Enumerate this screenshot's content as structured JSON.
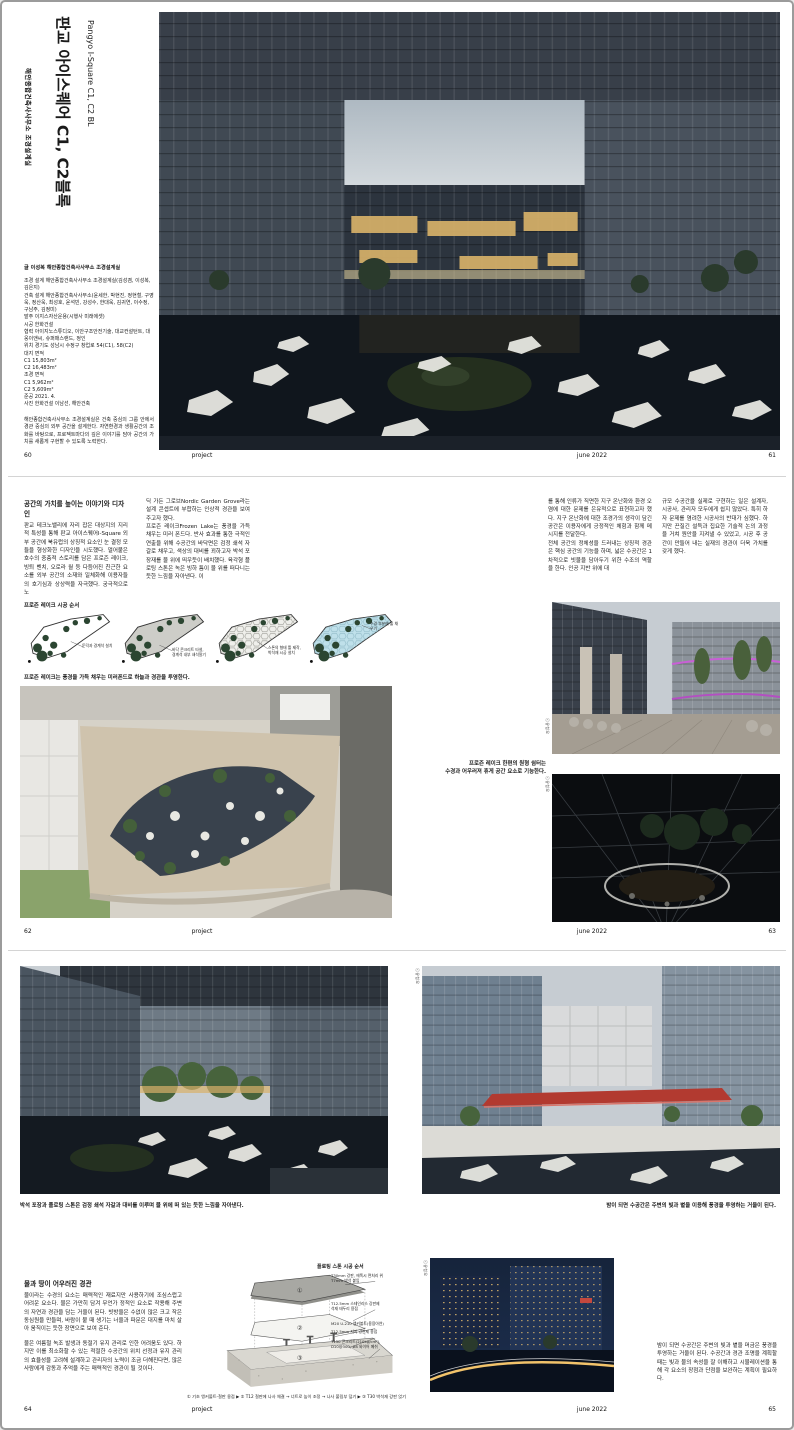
{
  "footer": {
    "section_label": "project",
    "issue_label": "june 2022"
  },
  "spread1": {
    "page_left": "60",
    "page_right": "61",
    "title_kr": "판교 아이스퀘어 C1, C2블록",
    "title_en": "Pangyo I-Square C1, C2 BL",
    "title_byline": "해안종합건축사사무소 조경설계실",
    "lead": "글 이성복  해안종합건축사사무소 조경설계실",
    "credits": [
      "조경 설계 해안종합건축사사무소 조경설계실(김성겸, 이성복, 김은지)",
      "건축 설계 해안종합건축사사무소(윤세한, 박현진, 정현철, 구영욱, 정산욱, 최성호, 윤석빈, 강성수, 한대욱, 김귀연, 이수정, 구남주, 김정미)",
      "발주 이지스자산운용(시행사 미래에셋)",
      "시공 한화건설",
      "협력 아이지노스튜디오, 이안구조안전기술, 대교컨설턴트, 대웅이앤씨, 슈퍼매스랜드, 정인",
      "위치 경기도 성남시 수정구 창업로 54(C1), 58(C2)",
      "대지 면적",
      "C1 15,803m²",
      "C2 16,483m²",
      "조경 면적",
      "C1 5,962m²",
      "C2 5,609m²",
      "준공 2021. 4.",
      "사진 한화건설 이남선, 해안건축"
    ],
    "firm_note": "해안종합건축사사무소 조경설계실은 건축 중심의 그룹 안에서 경관 중심의 외부 공간을 설계한다. 자연환경과 생활공간의 조화를 바탕으로, 프로젝트마다의 깊은 이야기를 담아 공간의 가치를 새롭게 구현할 수 있도록 노력한다."
  },
  "spread2": {
    "page_left": "62",
    "page_right": "63",
    "heading": "공간의 가치를 높이는 이야기와 디자인",
    "col1": "판교 테크노밸리에 자리 잡은 대상지의 지리적 특성을 통해 판교 아이스퀘어I-Square 외부 공간에 북유럽의 상징적 요소인 눈 결정 모듈을 형상화한 디자인을 시도했다. 얼어붙은 호수의 중층적 스토리를 담은 프로즌 레이크, 빙퇴 벤치, 오로라 월 등 다듬어진 친근한 요소를 외부 공간의 소재와 일체화해 이용자들의 호기심과 상상력을 자극했다. 궁극적으로 노",
    "col2": "딕 가든 그로브Nordic Garden Grove라는 설계 콘셉트에 부합하는 인상적 경관을 보여주고자 했다.\n프로즌 레이크Frozen Lake는 풍경을 가득 채우는 미러 폰드다. 반사 효과를 통한 극적인 연출을 위해 수공간의 바닥면은 검정 쇄석 자갈로 채우고, 색상의 대비를 꾀하고자 박석 포장재를 물 위에 띄우듯이 배치했다. 육각형 플로팅 스톤은 녹은 빙하 틈이 물 위를 떠다니는 듯한 느낌을 자아낸다. 이",
    "col3": "를 통해 인류가 직면한 지구 온난화와 환경 오염에 대한 문제를 은유적으로 표현하고자 했다. 지구 온난화에 대한 조경가의 생각이 담긴 공간은 이용자에게 긍정적인 체험과 함께 메시지를 전달한다.\n전체 공간의 정체성을 드러내는 상징적 경관은 핵심 공간의 기능을 하며, 넓은 수공간은 1차적으로 빗물을 담아두기 위한 수조의 역할을 한다. 인공 지반 위에 대",
    "col4": "규모 수공간을 실제로 구현하는 일은 설계자, 시공사, 관리자 모두에게 쉽지 않았다. 특히 하자 문제를 염려한 시공사의 반대가 심했다. 하지만 끈질긴 설득과 집요한 기술적 논의 과정을 거쳐 원안을 지켜낼 수 있었고, 시공 후 공간이 만들어 내는 실재의 경관이 더욱 가치를 갖게 했다.",
    "diagram_title": "프로즌 레이크 시공 순서",
    "diagram_steps": [
      "둔덕과 경계석 설치",
      "바닥 콘크리트 타설,\n경계석 내부 쇄석깔기",
      "스톤의 형태 틀 제작,\n박석재 시공 설치",
      "수경 부분에 물 채우기"
    ],
    "aerial_caption": "프로즌 레이크는 풍경을 가득 채우는 미러폰드로 하늘과 경관을 투영한다.",
    "photo_caption": "프로즌 레이크 한편의 원형 쉼터는\n수경과 어우러져 휴게 공간 요소로 기능한다.",
    "photo_credit": "ⓒ유청오"
  },
  "spread3": {
    "page_left": "64",
    "page_right": "65",
    "caption_left": "박석 포장과 플로팅 스톤은 검정 쇄석 자갈과 대비를 이루며 물 위에 떠 있는 듯한 느낌을 자아낸다.",
    "caption_right": "밤이 되면 수공간은 주변의 빛과 볕을 이용해 풍경을 투영하는 거울이 된다.",
    "essay_heading": "물과 땅이 어우러진 경관",
    "essay_p1": "물이라는 수경의 요소는 매력적인 재료지만 사용하기에 조심스럽고 어려운 요소다. 물은 가만히 담겨 무언가 정적인 요소로 작용해 주변의 자연과 경관을 담는 거울이 된다. 빗방울은 수없이 많은 크고 작은 동심원을 만들며, 바람이 불 때 생기는 너울과 파문은 대지를 마치 살아 움직이는 듯한 장면으로 보여 준다.",
    "essay_p2": "물은 여름철 녹조 발생과 동절기 유지 관리로 인한 어려움도 있다. 하지만 이를 최소화할 수 있는 적절한 수공간의 위치 선정과 유지 관리의 효율성을 고려해 설계하고 관리자의 노력이 조금 더해진다면, 많은 사람에게 감동과 추억을 주는 매력적인 경관이 될 것이다.",
    "detail_title": "플로팅 스톤 시공 순서",
    "detail_labels": [
      "T30mm 강판, 에폭시 면처리 위\nT7mm 박석 붙임",
      "T12.5mm 스테인리스 강판제\n석재 테두리 용접",
      "M20 U-210 앵커볼트(용융아연)",
      "T12.5mm 지지 강판제 용접",
      "T150 콘크리트(210kg/cm²),\nD10@300, #8 와이어 메쉬"
    ],
    "detail_marks": [
      "①",
      "②",
      "③"
    ],
    "detail_sequence": "① 기초 앵커볼트-철판 용접 ▶ ② T12 철판에 나사 체결 → 너트로 높이 조정 → 나사 풀림부 덮기 ▶ ③ T30 박석재 강판 얹기",
    "outro": "밤이 되면 수공간은 주변의 빛과 볕을 머금은 풍경을 투영하는 거울이 된다. 수공간과 경관 조명을 계획할 때는 빛과 물의 속성을 잘 이해하고 시뮬레이션을 통해 각 요소의 장점과 단점을 보완하는 계획이 필요하다.",
    "photo_credit": "ⓒ유청오"
  }
}
